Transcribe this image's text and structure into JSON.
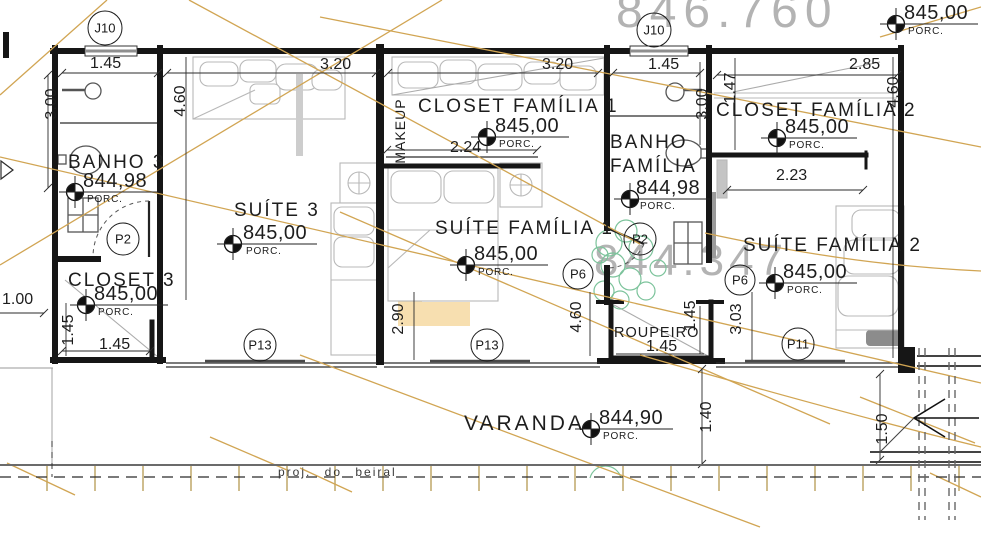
{
  "survey": {
    "top": "846.760",
    "middle": "844.347"
  },
  "rooms": [
    {
      "name": "BANHO 3",
      "elevation": "844,98",
      "finish": "PORC."
    },
    {
      "name": "CLOSET 3",
      "elevation": "845,00",
      "finish": "PORC."
    },
    {
      "name": "SUÍTE 3",
      "elevation": "845,00",
      "finish": "PORC."
    },
    {
      "name": "CLOSET FAMÍLIA 1",
      "elevation": "845,00",
      "finish": "PORC."
    },
    {
      "name": "SUÍTE FAMÍLIA 1",
      "elevation": "845,00",
      "finish": "PORC."
    },
    {
      "name": "BANHO FAMÍLIA",
      "elevation": "844,98",
      "finish": "PORC."
    },
    {
      "name": "CLOSET FAMÍLIA 2",
      "elevation": "845,00",
      "finish": "PORC."
    },
    {
      "name": "SUÍTE FAMÍLIA 2",
      "elevation": "845,00",
      "finish": "PORC."
    },
    {
      "name": "ROUPEIRO"
    },
    {
      "name": "VARANDA",
      "elevation": "844,90",
      "finish": "PORC."
    }
  ],
  "exterior_marker": {
    "elevation": "845,00",
    "finish": "PORC."
  },
  "bubbles": [
    "J10",
    "J10",
    "P2",
    "P13",
    "P13",
    "P6",
    "P2",
    "P6",
    "P11"
  ],
  "dims": [
    "1.45",
    "3.00",
    "4.60",
    "3.20",
    "3.20",
    "2.24",
    "1.45",
    "3.00",
    "1.47",
    "2.85",
    "4.60",
    "2.23",
    "2.90",
    "4.60",
    "3.03",
    "1.45",
    "1.45",
    "1.45",
    "1.45",
    "1.00",
    "1.40",
    "1.50"
  ],
  "annotations": {
    "makeup": "MAKEUP",
    "eave_projection": "proj. do beiral"
  },
  "colors": {
    "wall": "#161616",
    "contour": "#d1a553",
    "furniture": "#b8b8b8",
    "plant": "#7cc39b",
    "watermark": "#f6d9a2",
    "survey_text": "#b3b3b3"
  }
}
